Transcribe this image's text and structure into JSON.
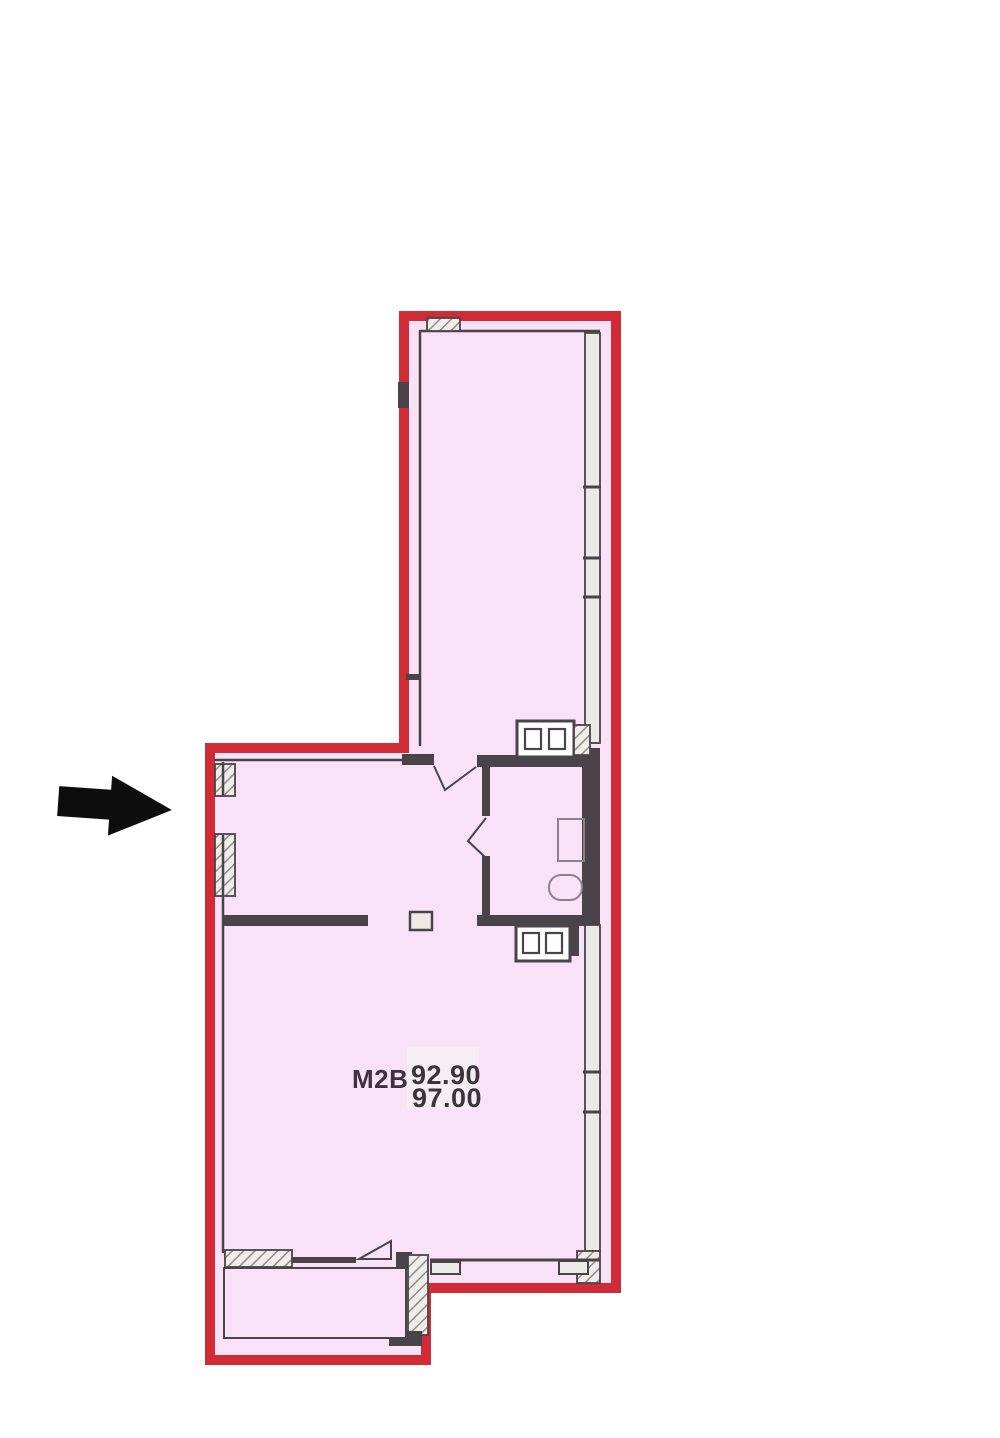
{
  "plan": {
    "unit_label": "M2B",
    "area_values": {
      "line1": "92.90",
      "line2": "97.00"
    },
    "icons": {
      "entrance_arrow": "right-arrow"
    },
    "colors": {
      "outline": "#d12b36",
      "fill": "#f9e1f8",
      "wall": "#4a4349",
      "window": "#eceae7",
      "hatch_line": "#8f8b88",
      "hatch_bg": "#f0ece9",
      "fixture": "#8a8489",
      "label": "#3c343d",
      "arrow": "#0d0d0d",
      "highlight": "#f5edf3",
      "page_bg": "#ffffff"
    }
  }
}
